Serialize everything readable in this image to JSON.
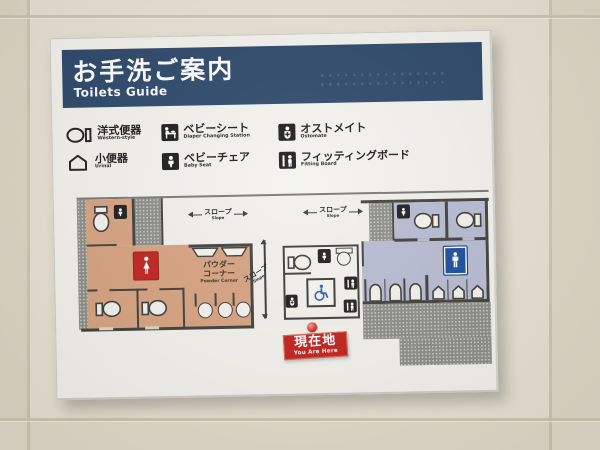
{
  "board": {
    "header": {
      "title_jp": "お手洗ご案内",
      "title_en": "Toilets Guide"
    },
    "legend": {
      "items": [
        {
          "jp": "洋式便器",
          "en": "Western-style",
          "icon": "western-toilet-icon"
        },
        {
          "jp": "小便器",
          "en": "Urinal",
          "icon": "urinal-icon"
        },
        {
          "jp": "ベビーシート",
          "en": "Diaper Changing Station",
          "icon": "diaper-changing-icon"
        },
        {
          "jp": "ベビーチェア",
          "en": "Baby Seat",
          "icon": "baby-seat-icon"
        },
        {
          "jp": "オストメイト",
          "en": "Ostomate",
          "icon": "ostomate-icon"
        },
        {
          "jp": "フィッティングボード",
          "en": "Fitting Board",
          "icon": "fitting-board-icon"
        }
      ]
    },
    "map": {
      "slope_top_left": {
        "jp": "スロープ",
        "en": "Slope"
      },
      "slope_top_right": {
        "jp": "スロープ",
        "en": "Slope"
      },
      "slope_vertical": {
        "jp": "スロープ",
        "en": "Slope"
      },
      "powder_corner": {
        "jp_line1": "パウダー",
        "jp_line2": "コーナー",
        "en": "Powder Corner"
      },
      "you_are_here": {
        "jp": "現在地",
        "en": "You Are Here"
      }
    },
    "colors": {
      "header_navy": "#2d486a",
      "women_area": "#d8a381",
      "women_sign_red": "#bf2420",
      "men_area": "#b8bdd3",
      "men_sign_blue": "#1d4f9f",
      "wheelchair_blue": "#2b5ec2",
      "marker_red": "#c2231d",
      "hatch_gray": "#8e8e89",
      "board_white": "#f4f3ee",
      "wall_beige": "#e9e3d4"
    }
  }
}
